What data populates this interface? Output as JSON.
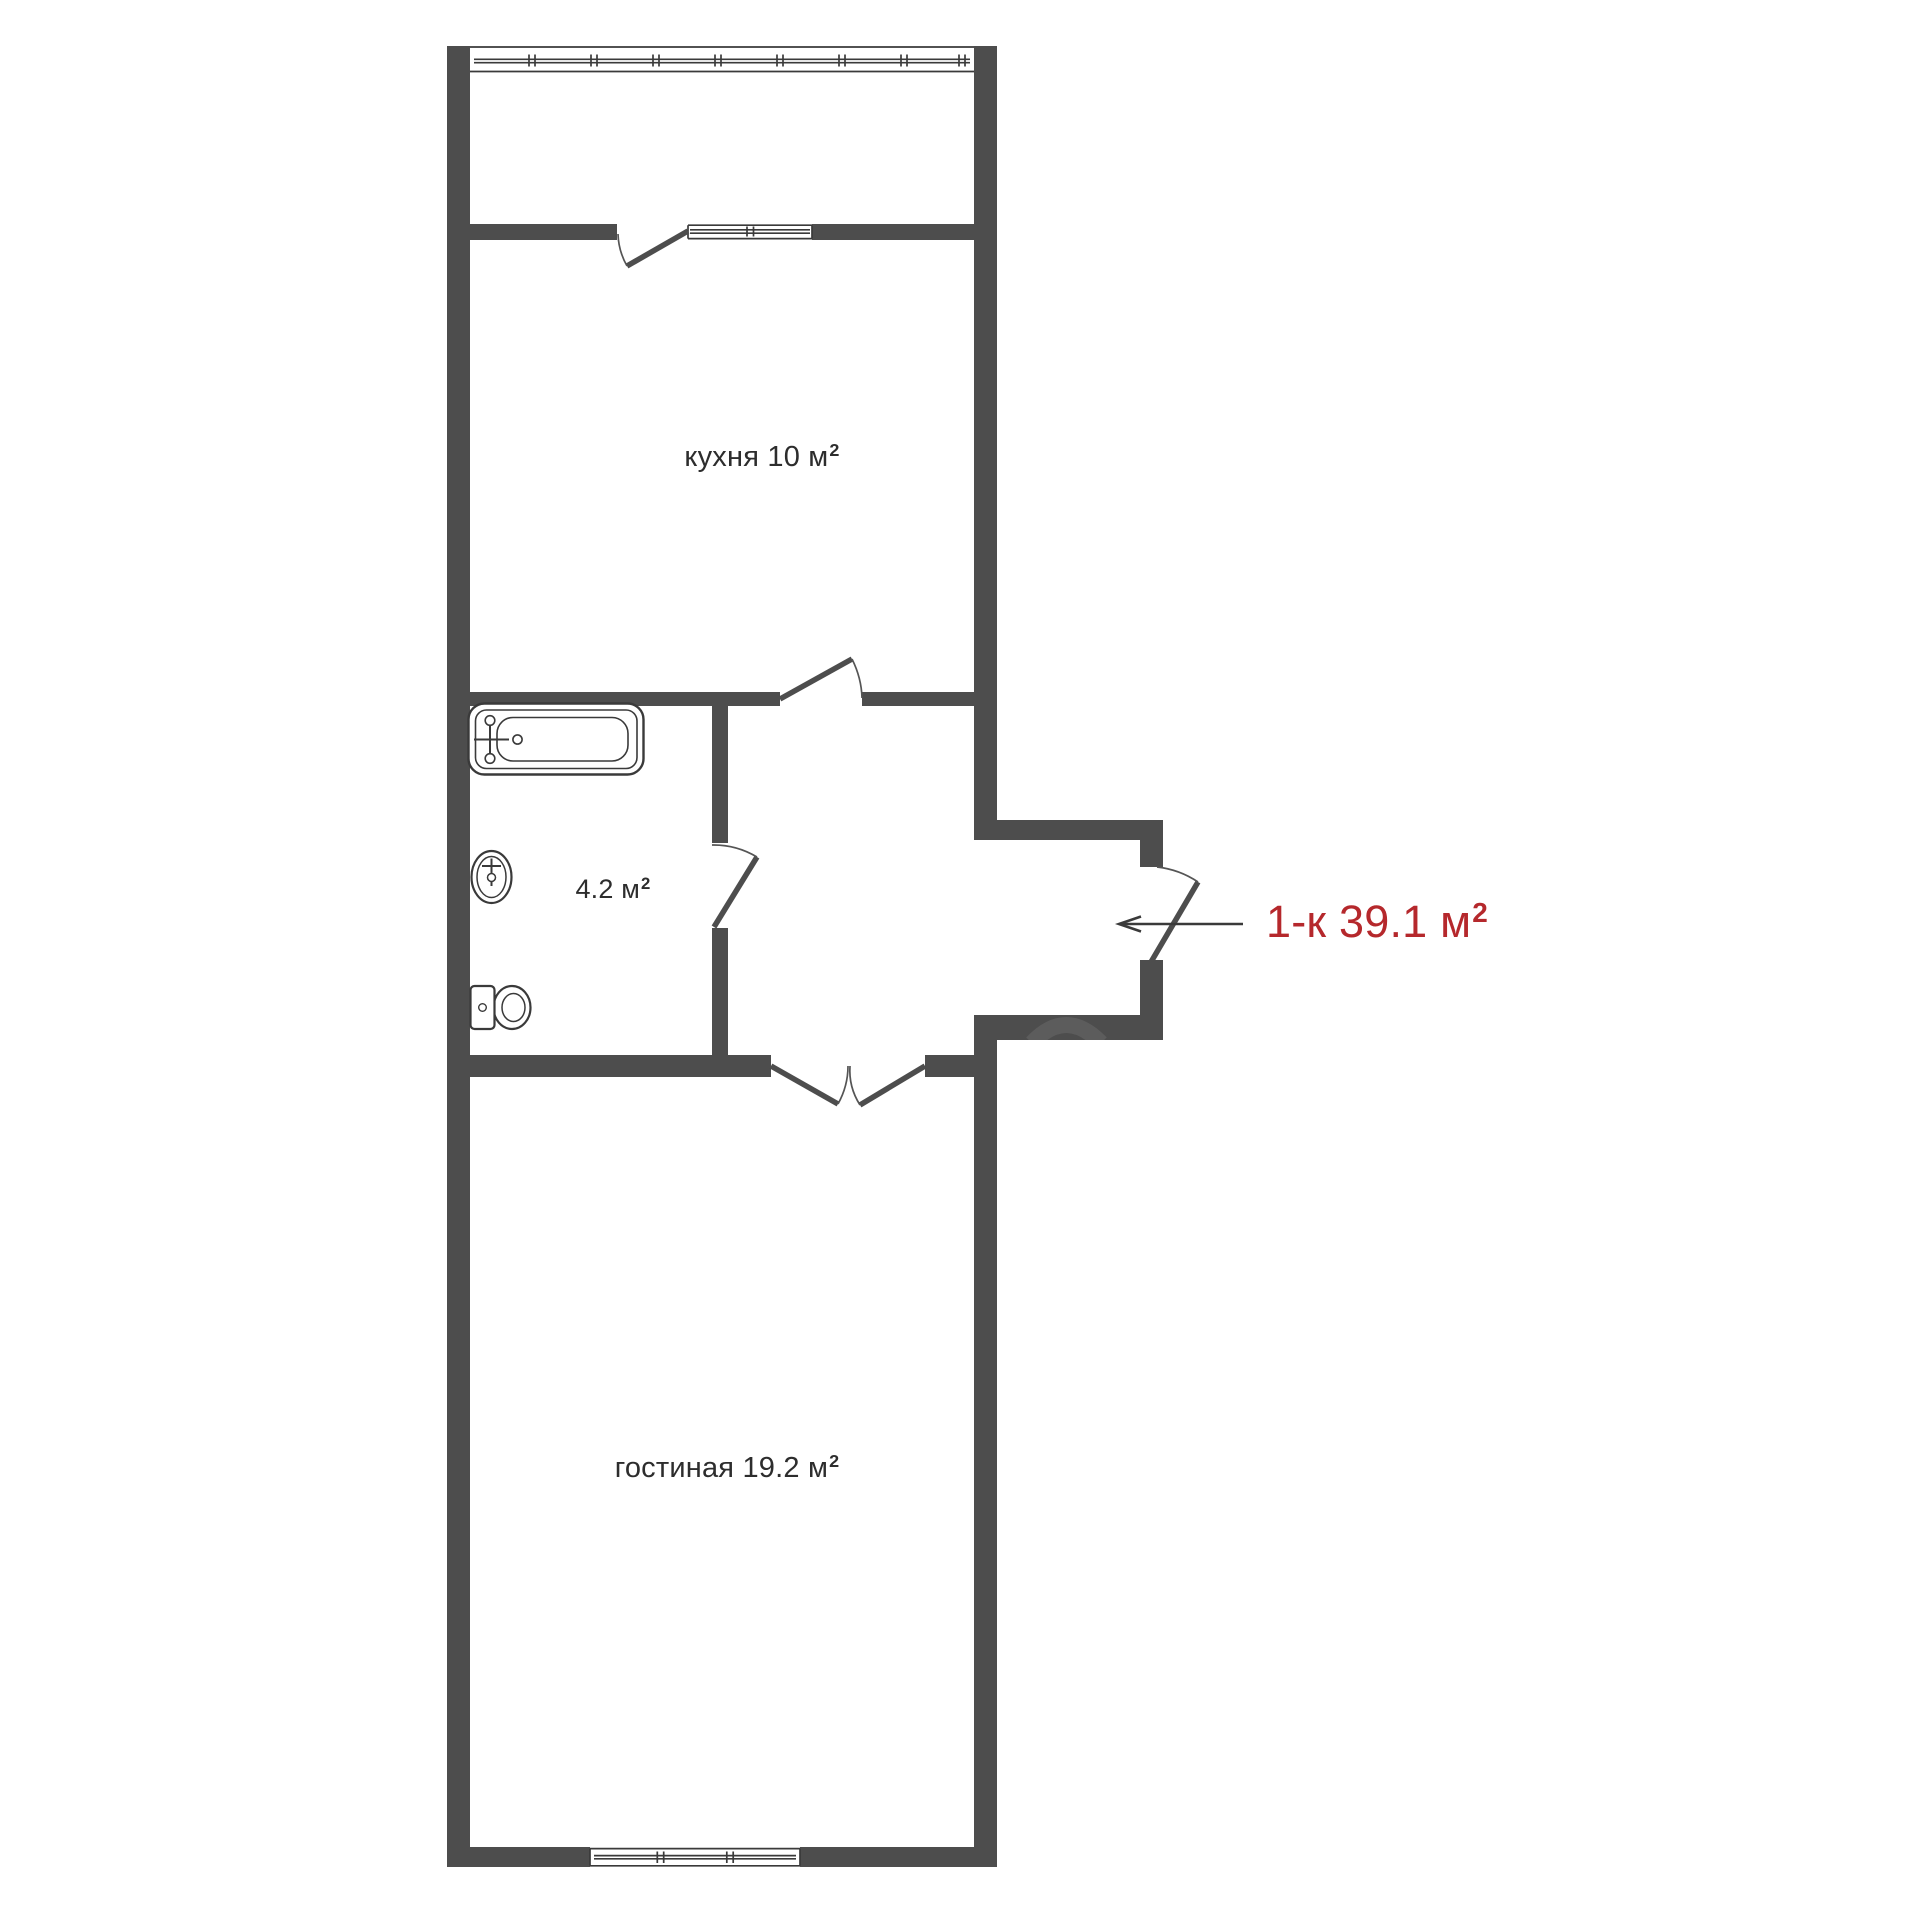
{
  "plan": {
    "colors": {
      "wall": "#4d4d4d",
      "fixture": "#3a3a3a",
      "thin": "#555555",
      "text": "#2d2d2d",
      "accent": "#b5282c"
    },
    "labels": {
      "kitchen": {
        "text": "кухня 10 м",
        "sup": "2"
      },
      "bathroom": {
        "text": "4.2 м",
        "sup": "2"
      },
      "living_room": {
        "text": "гостиная 19.2 м",
        "sup": "2"
      },
      "apartment": {
        "text": "1-к 39.1 м",
        "sup": "2"
      }
    },
    "rooms": [
      {
        "label": "кухня",
        "area": "10 м²"
      },
      {
        "label": "санузел",
        "area": "4.2 м²"
      },
      {
        "label": "гостиная",
        "area": "19.2 м²"
      }
    ],
    "apartment_summary": "1-к 39.1 м²"
  }
}
